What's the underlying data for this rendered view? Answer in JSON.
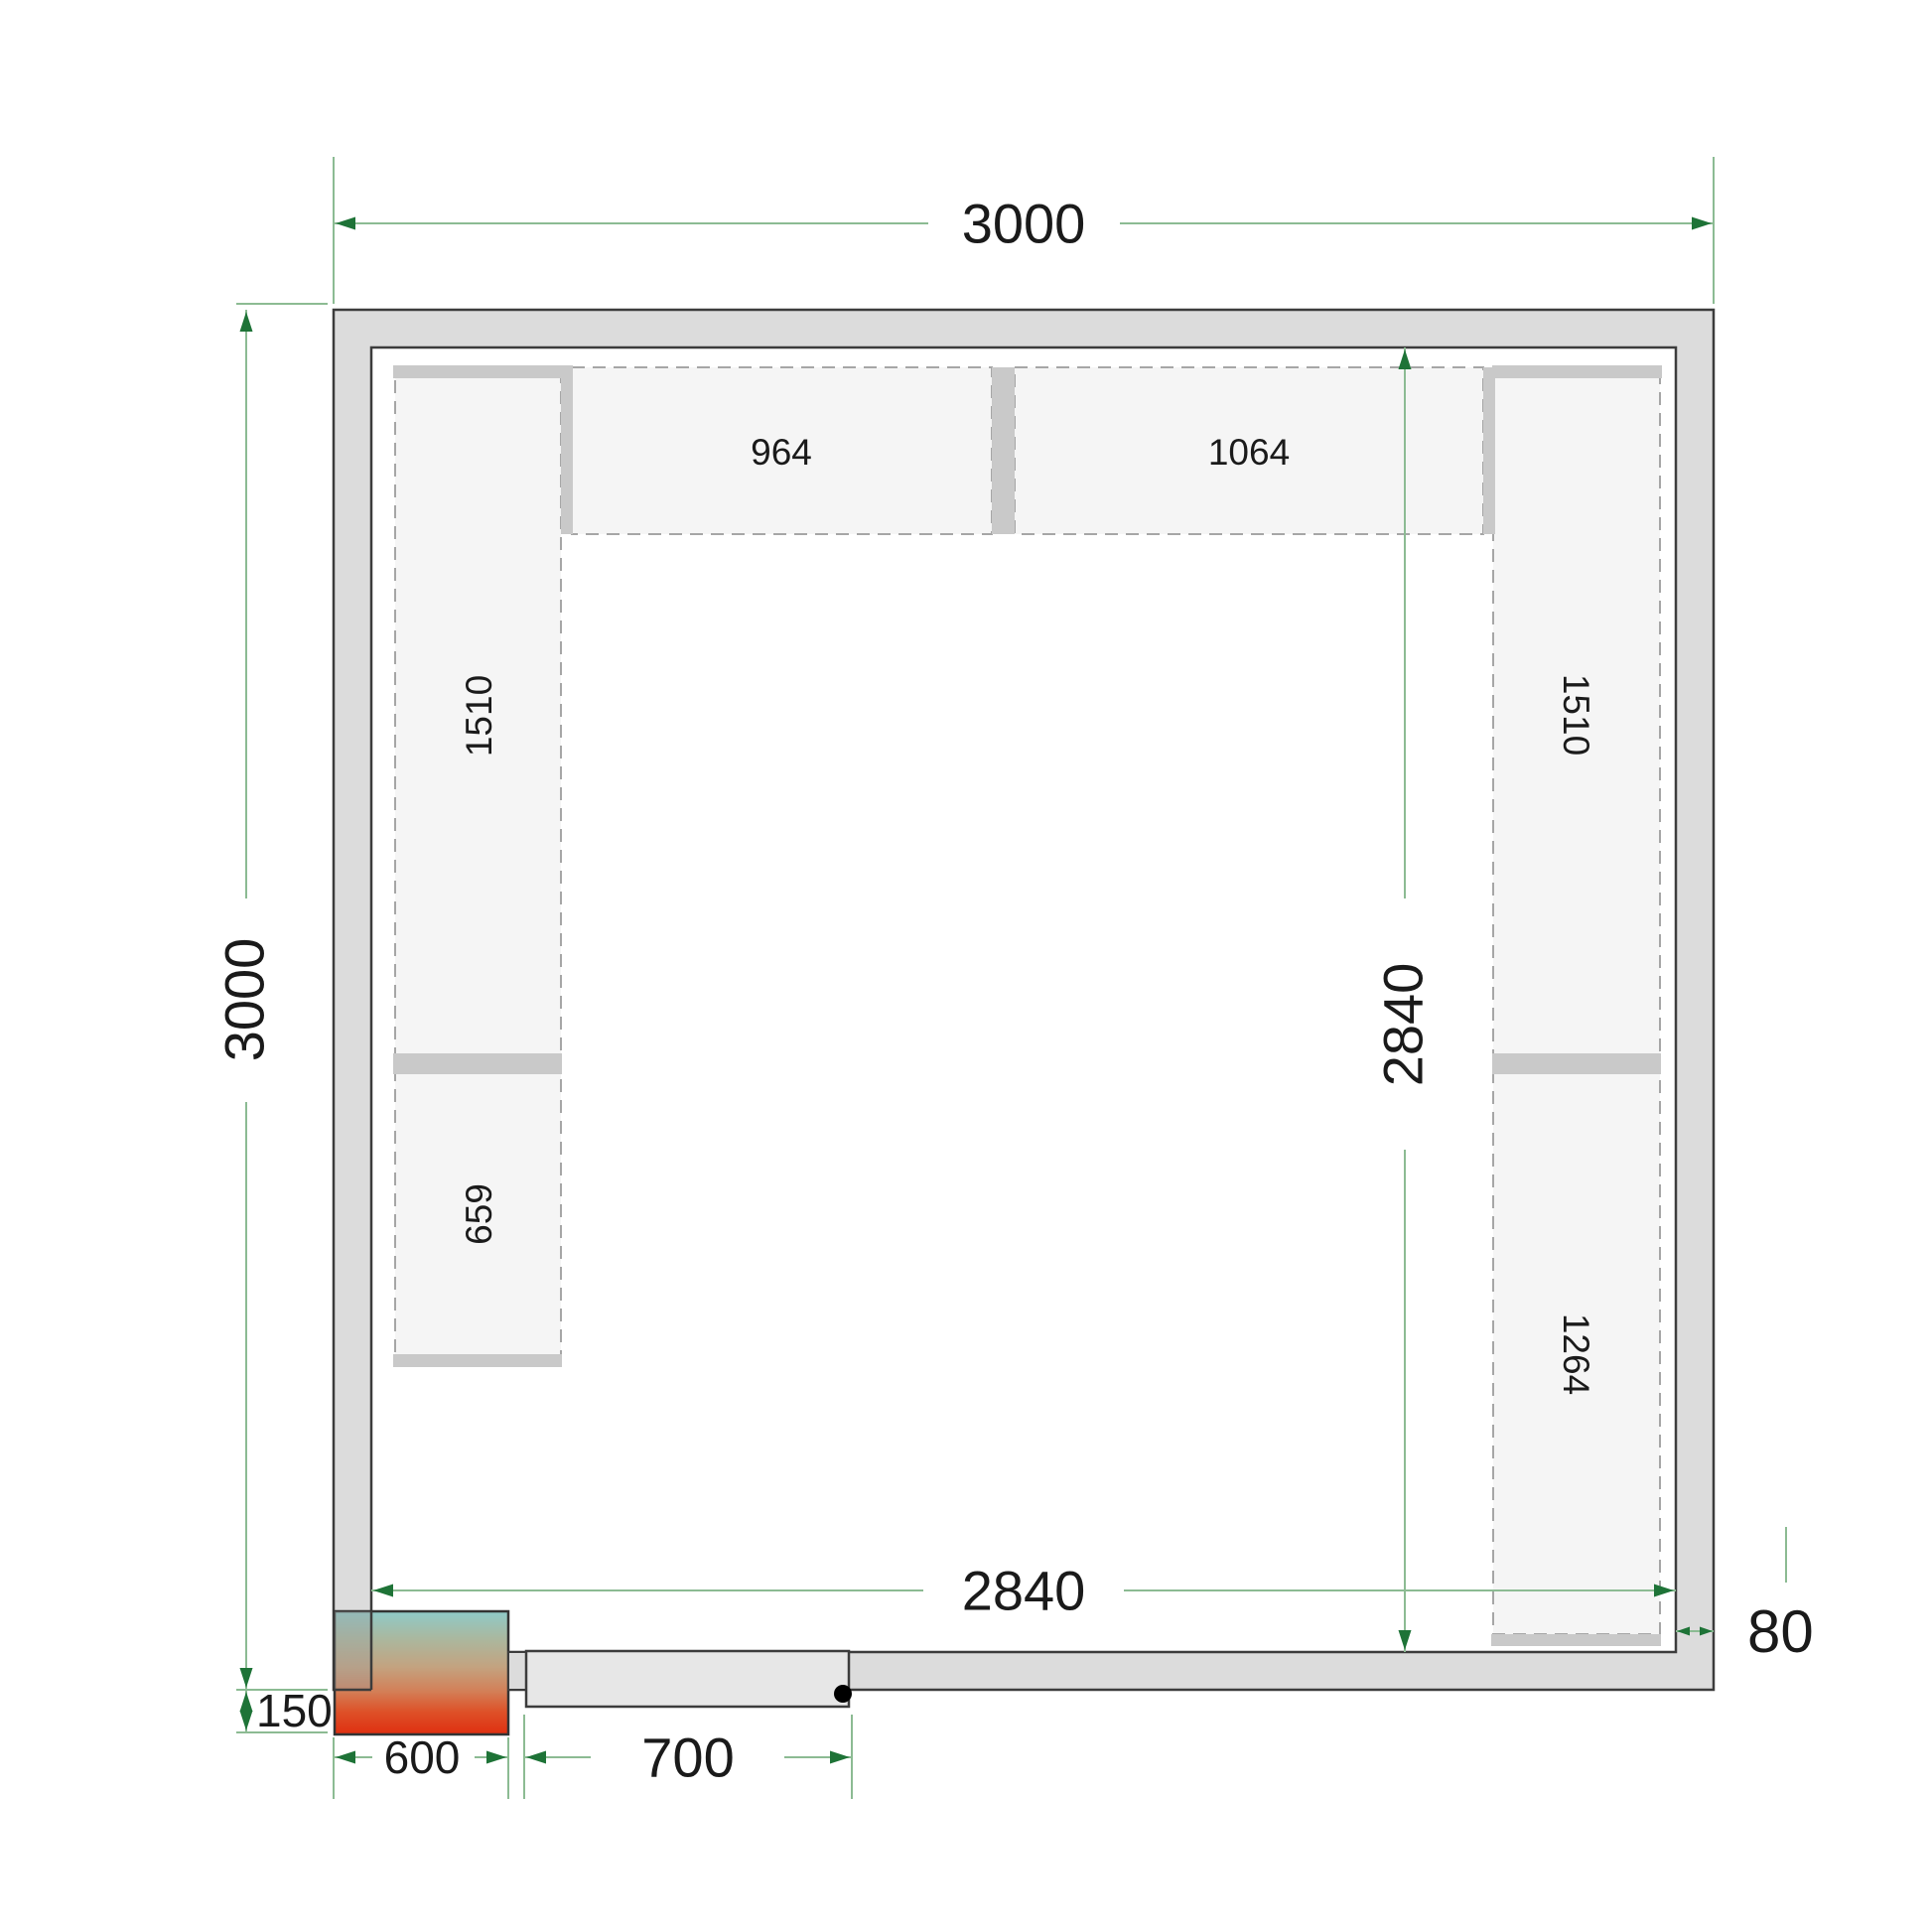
{
  "drawing": {
    "type": "cold-room floor plan, top view",
    "colors": {
      "dimension_line": "#8cbb93",
      "dimension_arrow": "#1e7337",
      "text": "#1a1a1a",
      "wall_fill": "#dcdcdc",
      "wall_border": "#3c3c3c",
      "shelf_fill": "#f5f5f5",
      "shelf_dash": "#a6a6a6",
      "bracket_fill": "#c9c9c9",
      "door_fill": "#e7e7e7",
      "hinge_dot": "#000000"
    }
  },
  "unit": {
    "gradient": [
      "#8ecac8",
      "#aab89f",
      "#c3a380",
      "#d37f57",
      "#de5027",
      "#df2f10"
    ]
  },
  "dimensions": {
    "outer_width": "3000",
    "outer_height": "3000",
    "inner_width": "2840",
    "inner_height": "2840",
    "wall_thickness": "80",
    "unit_protrusion": "150",
    "unit_width": "600",
    "door_width": "700"
  },
  "shelves": {
    "left_top": "1510",
    "left_bottom": "659",
    "top_left": "964",
    "top_right": "1064",
    "right_top": "1510",
    "right_bottom": "1264"
  }
}
